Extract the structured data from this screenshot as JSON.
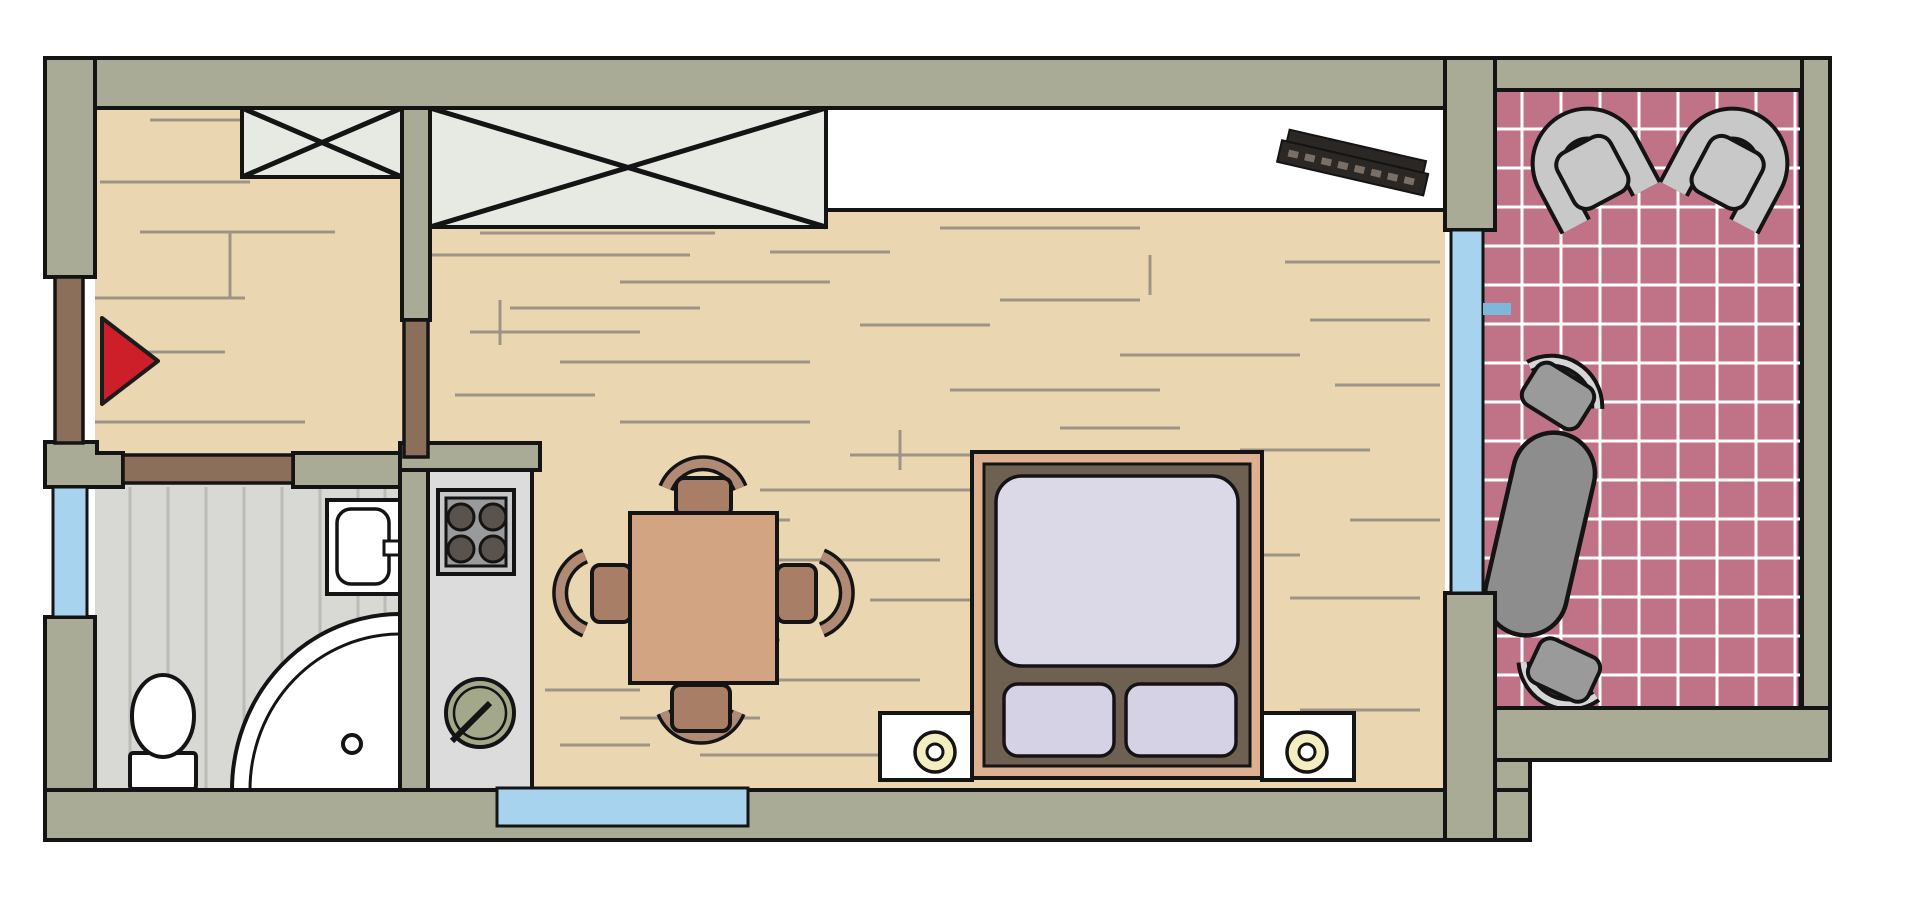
{
  "diagram": {
    "type": "apartment floor plan",
    "rooms": [
      {
        "name": "entry-hall",
        "floor": "wood",
        "features": [
          "entrance-arrow",
          "small-wardrobe"
        ]
      },
      {
        "name": "bathroom",
        "floor": "gray-striped-tile",
        "features": [
          "toilet",
          "washbasin",
          "corner-shower",
          "window"
        ]
      },
      {
        "name": "kitchenette",
        "features": [
          "counter",
          "stove-four-burners",
          "round-sink"
        ]
      },
      {
        "name": "living-sleeping-room",
        "floor": "wood",
        "features": [
          "large-wardrobe",
          "built-in-closet",
          "radiator",
          "double-bed",
          "two-nightstands-with-lamps",
          "dining-table",
          "four-chairs"
        ]
      },
      {
        "name": "balcony",
        "floor": "pink-grid-tile",
        "features": [
          "two-armchairs",
          "oval-table",
          "two-chairs",
          "glass-door"
        ]
      }
    ],
    "markers": {
      "entrance": "red-arrow"
    },
    "window_count": 3,
    "door_count": 3,
    "armchair_count": 2,
    "burner_count": 4,
    "pillow_count": 2,
    "dining_chair_count": 4
  },
  "colors": {
    "background": "#ffffff",
    "outline": "#141414",
    "wall": "#a9ab97",
    "wood": "#ebd6b2",
    "grain": "#9d9486",
    "bathFloor": "#d8d8d4",
    "bathStripe": "#bcbcb6",
    "tile": "#c07287",
    "tileLine": "#ffffff",
    "window": "#a7d3ee",
    "windowTick": "#7db8dc",
    "door": "#8b6f5b",
    "closet": "#e7e9e3",
    "fixture": "#ffffff",
    "counter": "#dcdcdc",
    "stoveFrame": "#c9c9c9",
    "stovePlate": "#9a9a9a",
    "burner": "#5a524c",
    "sink": "#a4a88b",
    "bedFrame": "#dcb091",
    "bedInner": "#6f6152",
    "mattress": "#dbd9e8",
    "pillow": "#d4d2e4",
    "lamp": "#f4edc0",
    "table": "#d2a482",
    "seat": "#a87e66",
    "arcFill": "#b08a74",
    "balconySeat": "#c8c8c8",
    "balconySeatSmall": "#9a9a9a",
    "balconyTable": "#8d8d8d",
    "radiator": "#2b2724",
    "arrow": "#cd1f2a"
  }
}
